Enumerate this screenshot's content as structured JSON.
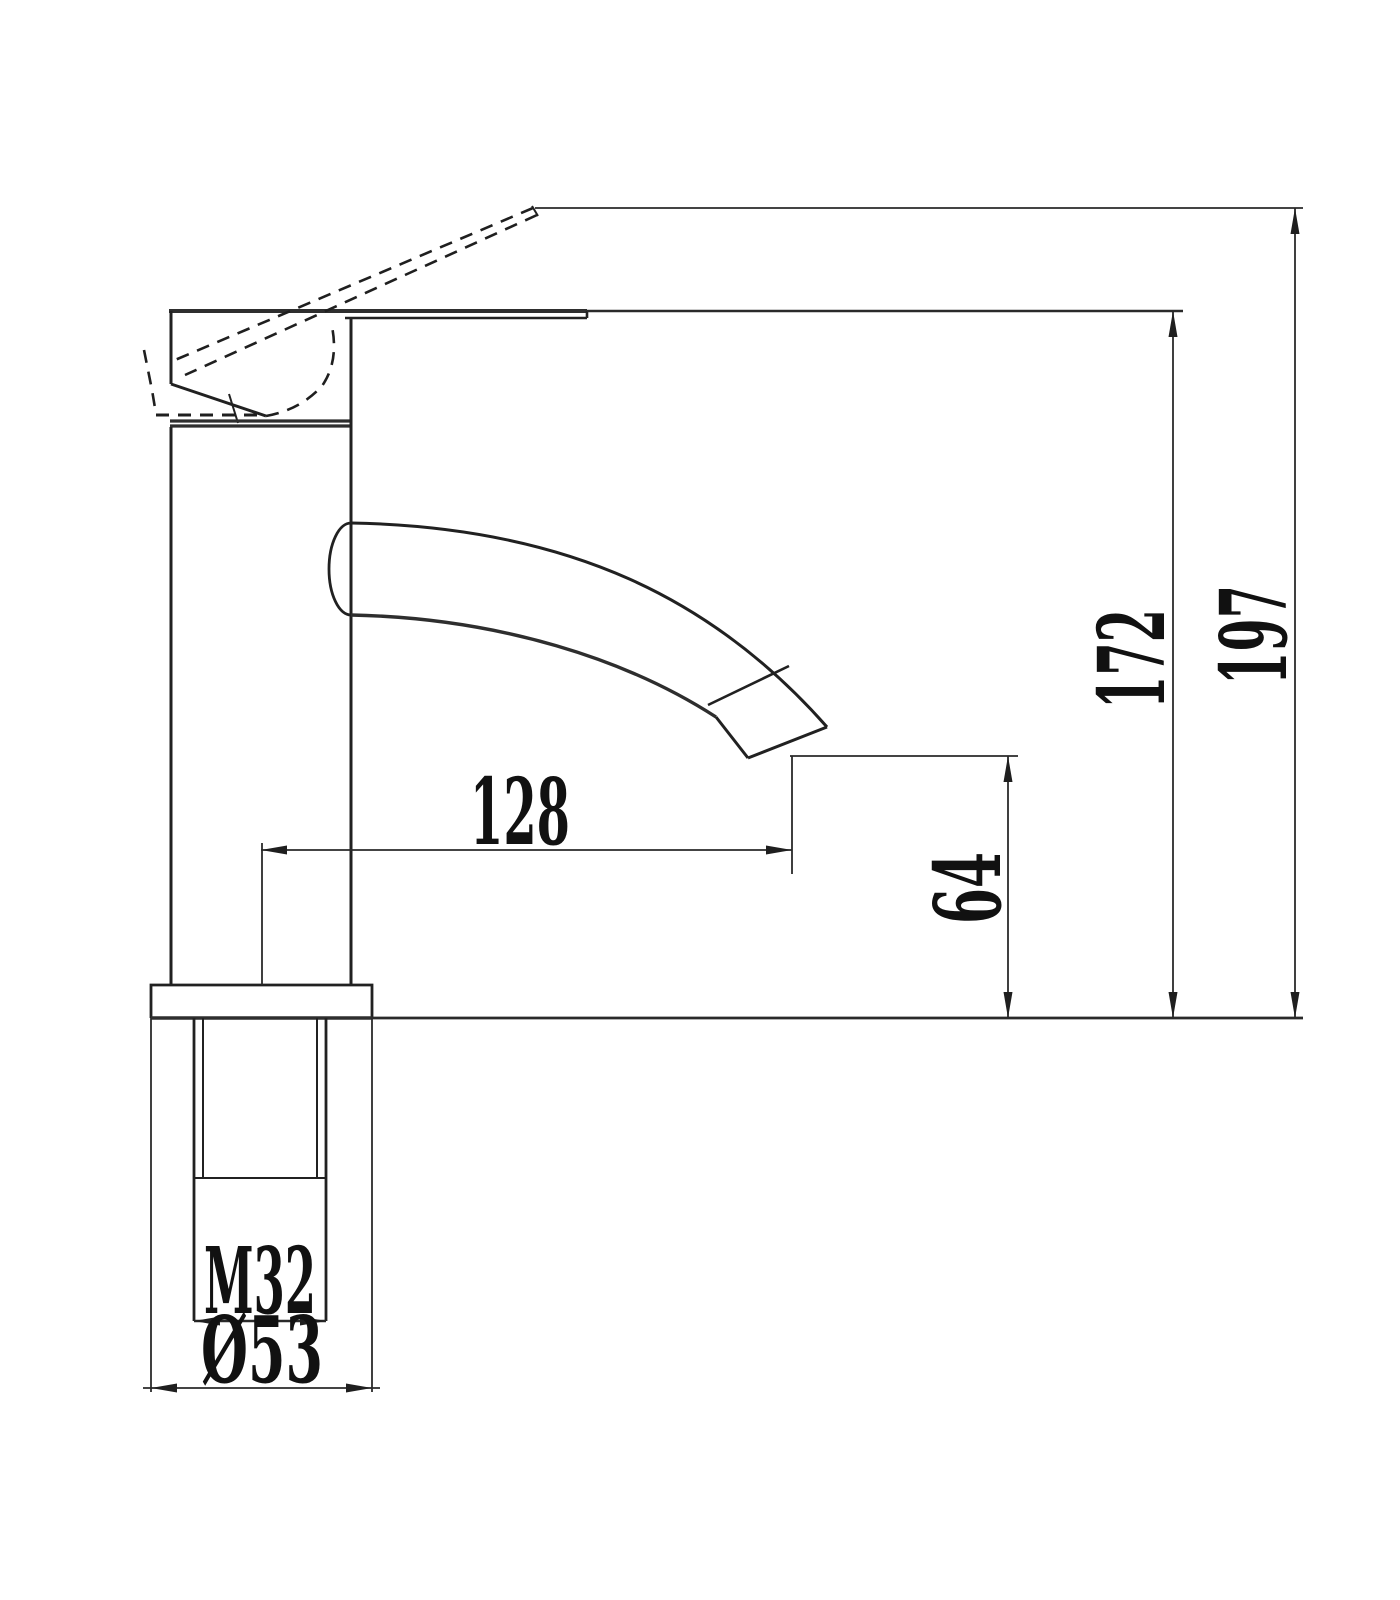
{
  "drawing": {
    "subject": "Single-lever basin mixer faucet - side elevation technical drawing",
    "view": "side elevation with raised handle position shown dashed",
    "units": "mm",
    "background_color": "#ffffff",
    "line_color": "#1f1f1f",
    "dimensions": {
      "total_height": "197",
      "height_to_handle_top": "172",
      "spout_reach": "128",
      "spout_outlet_height": "64",
      "thread_size": "M32",
      "base_diameter": "Ø53"
    }
  }
}
